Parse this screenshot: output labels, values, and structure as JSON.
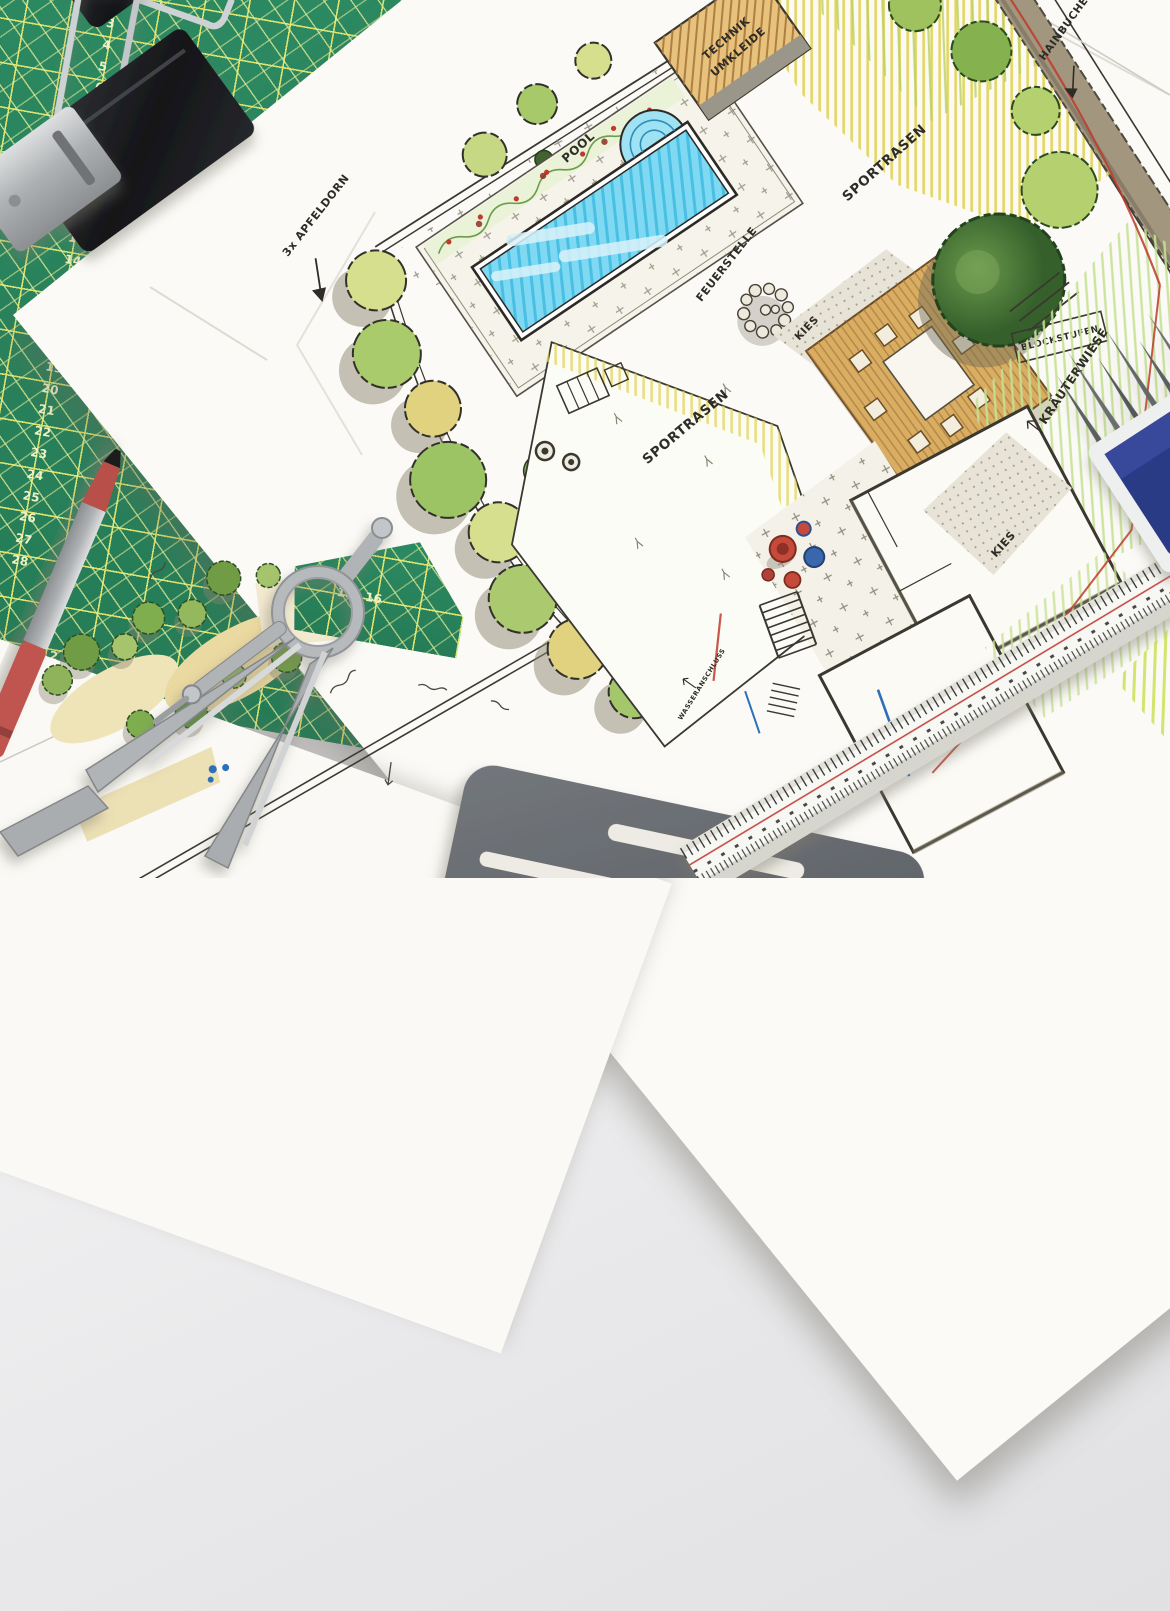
{
  "scene": {
    "description": "Hand-drawn garden design plan sketches on a drafting desk with cutting mat and drawing tools"
  },
  "cutting_mat": {
    "mat_green": "#2c8a62",
    "grid_yellow": "#dde36e",
    "left_scale": [
      "3",
      "4",
      "5",
      "6",
      "7",
      "8",
      "9",
      "10",
      "11",
      "12",
      "13",
      "14",
      "15",
      "16",
      "17",
      "18",
      "19",
      "20",
      "21",
      "22",
      "23",
      "24",
      "25",
      "26",
      "27",
      "28"
    ],
    "bottom_scale": [
      "2",
      "3"
    ],
    "wedge_scale": [
      "15",
      "16"
    ]
  },
  "plan": {
    "labels": {
      "pool": "POOL",
      "technik_line1": "TECHNIK",
      "technik_line2": "UMKLEIDE",
      "sportrasen_top": "SPORTRASEN",
      "sportrasen_center": "SPORTRASEN",
      "feuerstelle": "FEUERSTELLE",
      "kies_mid": "KIES",
      "kies_bottom": "KIES",
      "rasen": "RASEN",
      "blockstufen": "BLOCKSTUFEN",
      "kraeuterwiese": "KRÄUTERWIESE",
      "hainbuchenhecke": "HAINBUCHENHECKE",
      "apfeldorn": "3x APFELDORN",
      "wasseranschluss": "WASSERANSCHLUSS"
    },
    "colors": {
      "pool_blue": "#62cae9",
      "lawn_yellow": "#e2d455",
      "herb_green": "#c6e194",
      "deck_brown": "#d9ad62",
      "tree_dark_green": "#4e7c3b",
      "red_pencil": "#c0392b",
      "blue_pen": "#2d6fb8",
      "ink": "#3b382f"
    }
  },
  "tools": {
    "binder_clips": "2 black binder clips",
    "pen": "red fineliner pen",
    "sharpener": "metal sharpener",
    "compass": "grey drafting compass",
    "lead_box": "blue box of spare leads",
    "scale_ruler": "triangular scale ruler",
    "erasing_shield": "grey erasing shield stencil"
  }
}
